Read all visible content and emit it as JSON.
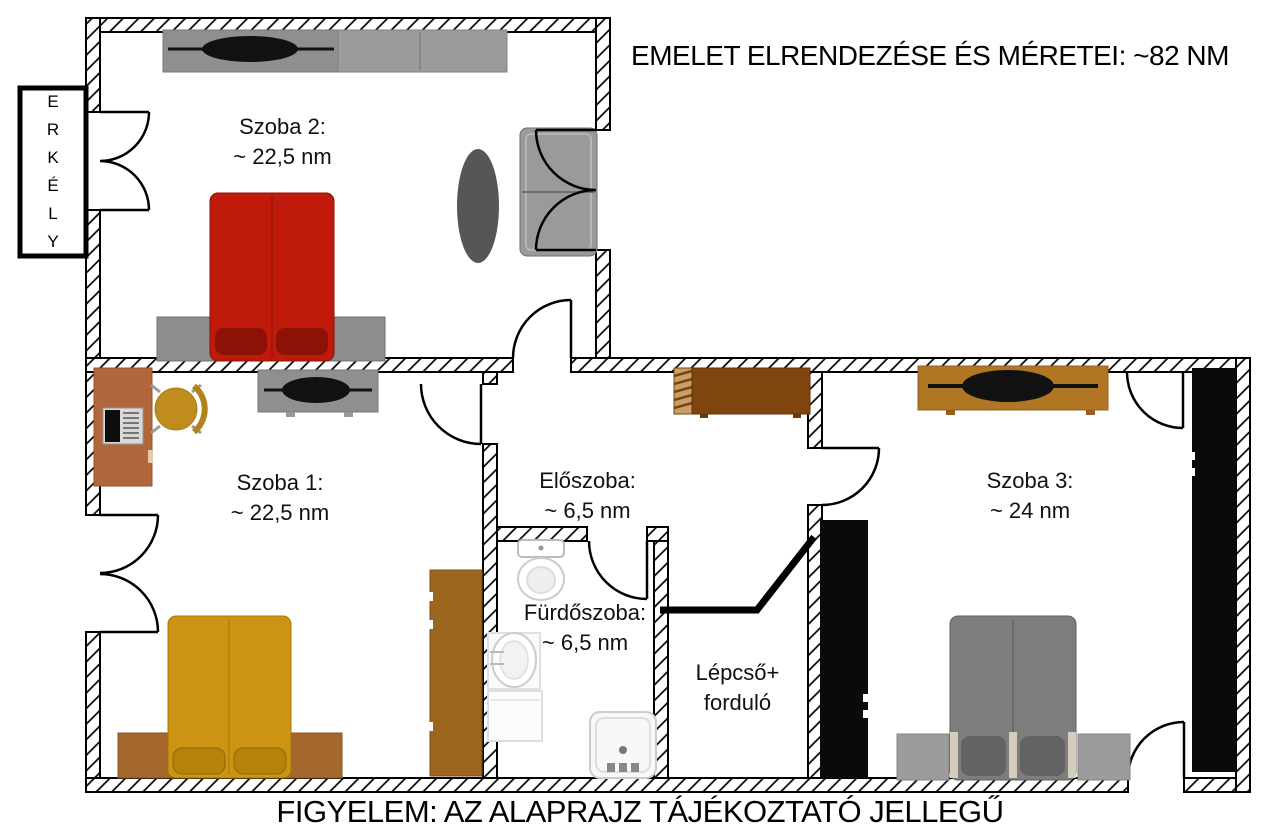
{
  "title": "EMELET ELRENDEZÉSE ÉS MÉRETEI: ~82 NM",
  "footer": "FIGYELEM: AZ ALAPRAJZ TÁJÉKOZTATÓ JELLEGŰ",
  "balcony": {
    "label": "ERKÉLY",
    "letters": [
      "E",
      "R",
      "K",
      "É",
      "L",
      "Y"
    ]
  },
  "rooms": {
    "szoba2": {
      "name": "Szoba 2:",
      "size": "~ 22,5 nm"
    },
    "szoba1": {
      "name": "Szoba 1:",
      "size": "~ 22,5 nm"
    },
    "eloszoba": {
      "name": "Előszoba:",
      "size": "~ 6,5 nm"
    },
    "furdoszoba": {
      "name": "Fürdőszoba:",
      "size": "~ 6,5 nm"
    },
    "lepcso": {
      "line1": "Lépcső+",
      "line2": "forduló"
    },
    "szoba3": {
      "name": "Szoba 3:",
      "size": "~ 24 nm"
    }
  },
  "colors": {
    "wall_line": "#000000",
    "bed_red": "#c01a0c",
    "bed_red_pillow": "#8d1206",
    "bed_yellow": "#cd9414",
    "bed_yellow_pillow": "#b5820a",
    "bed_gray": "#7d7d7d",
    "bed_gray_pillow": "#636363",
    "nightstand_brown": "#a5672c",
    "headboard_gray": "#8d8d8d",
    "cabinet_gray": "#8f8f8f",
    "wardrobe_gray": "#9b9b9b",
    "desk_brown": "#b2663c",
    "chair_gold": "#bf8c1d",
    "wardrobe_brown": "#9c651d",
    "wardrobe_black": "#0a0a0a",
    "sideboard_dark_brown": "#80450f",
    "tvstand_tan": "#b17623",
    "nightstand_gray": "#9c9c9c",
    "sofa_gray": "#9a9a9a",
    "table_dark": "#565656"
  }
}
